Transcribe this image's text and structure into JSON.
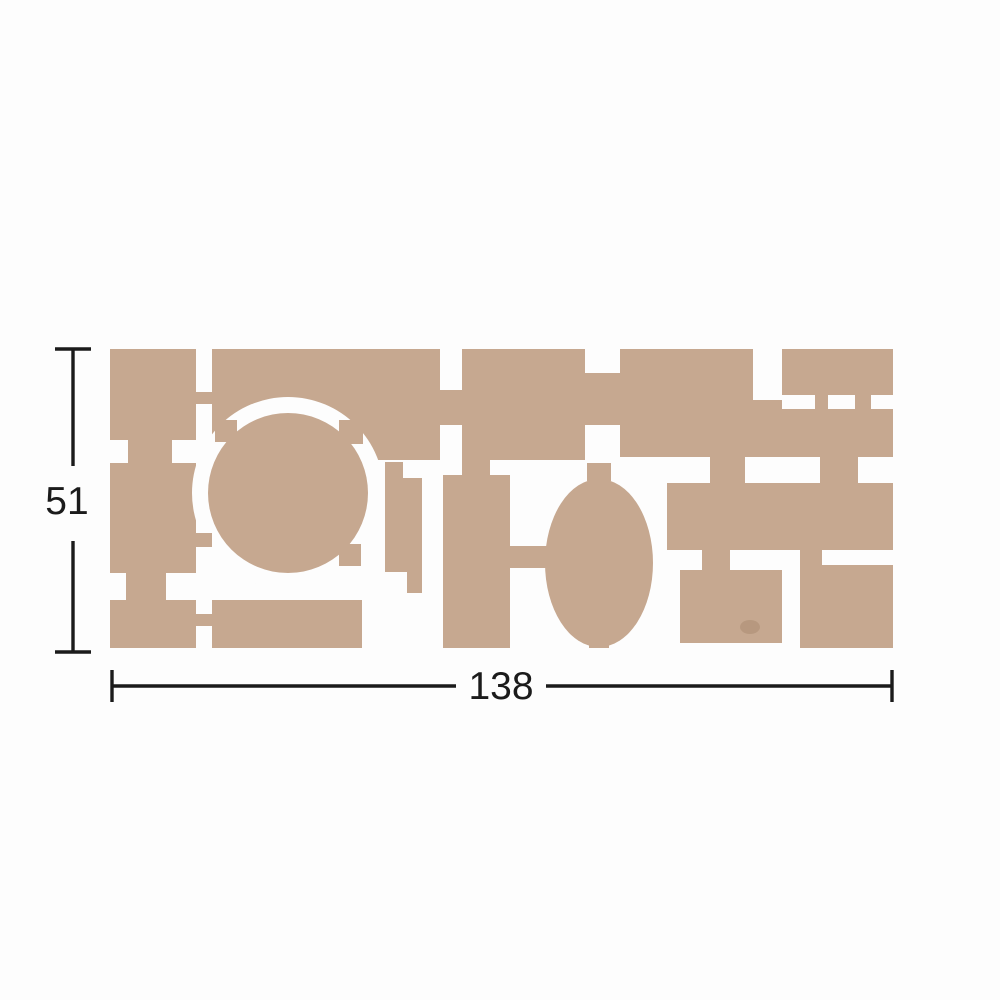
{
  "diagram": {
    "type": "product-dimension-drawing",
    "dimensions": {
      "width_label": "138",
      "height_label": "51"
    },
    "colors": {
      "sheet_tan": "#c6a890",
      "background": "#fdfdfd",
      "dimension_ink": "#1b1b1b"
    },
    "sheet": {
      "piece_shapes": [
        "rectangles",
        "circle",
        "oval"
      ],
      "description_visible": "laser-cut tan sheet of pieces joined by small tabs"
    }
  }
}
